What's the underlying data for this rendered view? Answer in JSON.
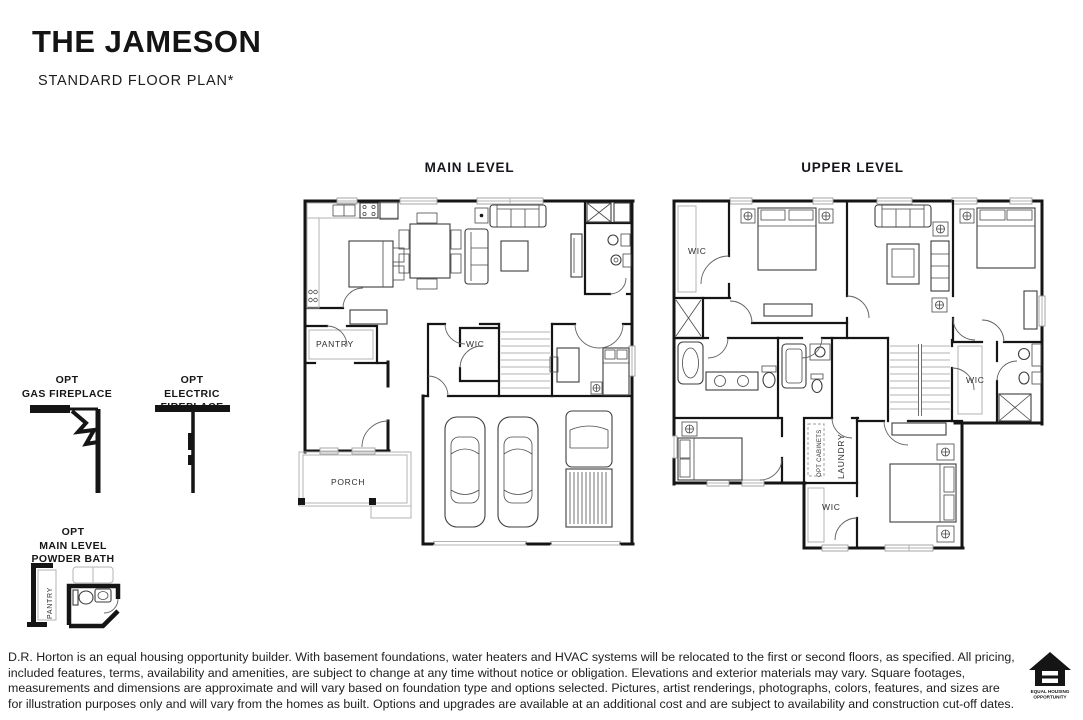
{
  "header": {
    "title": "THE JAMESON",
    "subtitle": "STANDARD FLOOR PLAN*"
  },
  "plans": {
    "main": {
      "heading": "MAIN LEVEL",
      "labels": {
        "pantry": "PANTRY",
        "wic": "WIC",
        "porch": "PORCH"
      }
    },
    "upper": {
      "heading": "UPPER LEVEL",
      "labels": {
        "wic_top_left": "WIC",
        "wic_right": "WIC",
        "wic_bottom": "WIC",
        "laundry": "LAUNDRY",
        "opt_cabinets": "OPT CABINETS"
      }
    }
  },
  "options": {
    "gas_fireplace": {
      "label": "OPT\nGAS FIREPLACE"
    },
    "electric_fireplace": {
      "label": "OPT\nELECTRIC FIREPLACE"
    },
    "powder_bath": {
      "label": "OPT\nMAIN LEVEL\nPOWDER BATH",
      "room_label": "PANTRY"
    }
  },
  "footer": {
    "disclaimer": "D.R. Horton is an equal housing opportunity builder. With basement foundations, water heaters and HVAC systems will be relocated to the first or second floors, as specified. All pricing, included features, terms, availability and amenities, are subject to change at any time without notice or obligation. Elevations and exterior materials may vary. Square footages, measurements and dimensions are approximate and will vary based on foundation type and options selected. Pictures, artist renderings, photographs, colors, features, and sizes are for illustration purposes only and will vary from the homes as built. Options and upgrades are available at an additional cost and are subject to availability and construction cut-off dates.",
    "eho": {
      "line1": "EQUAL HOUSING",
      "line2": "OPPORTUNITY"
    }
  },
  "colors": {
    "ink": "#151515",
    "light_gray": "#b3b3b3",
    "background": "#ffffff"
  }
}
